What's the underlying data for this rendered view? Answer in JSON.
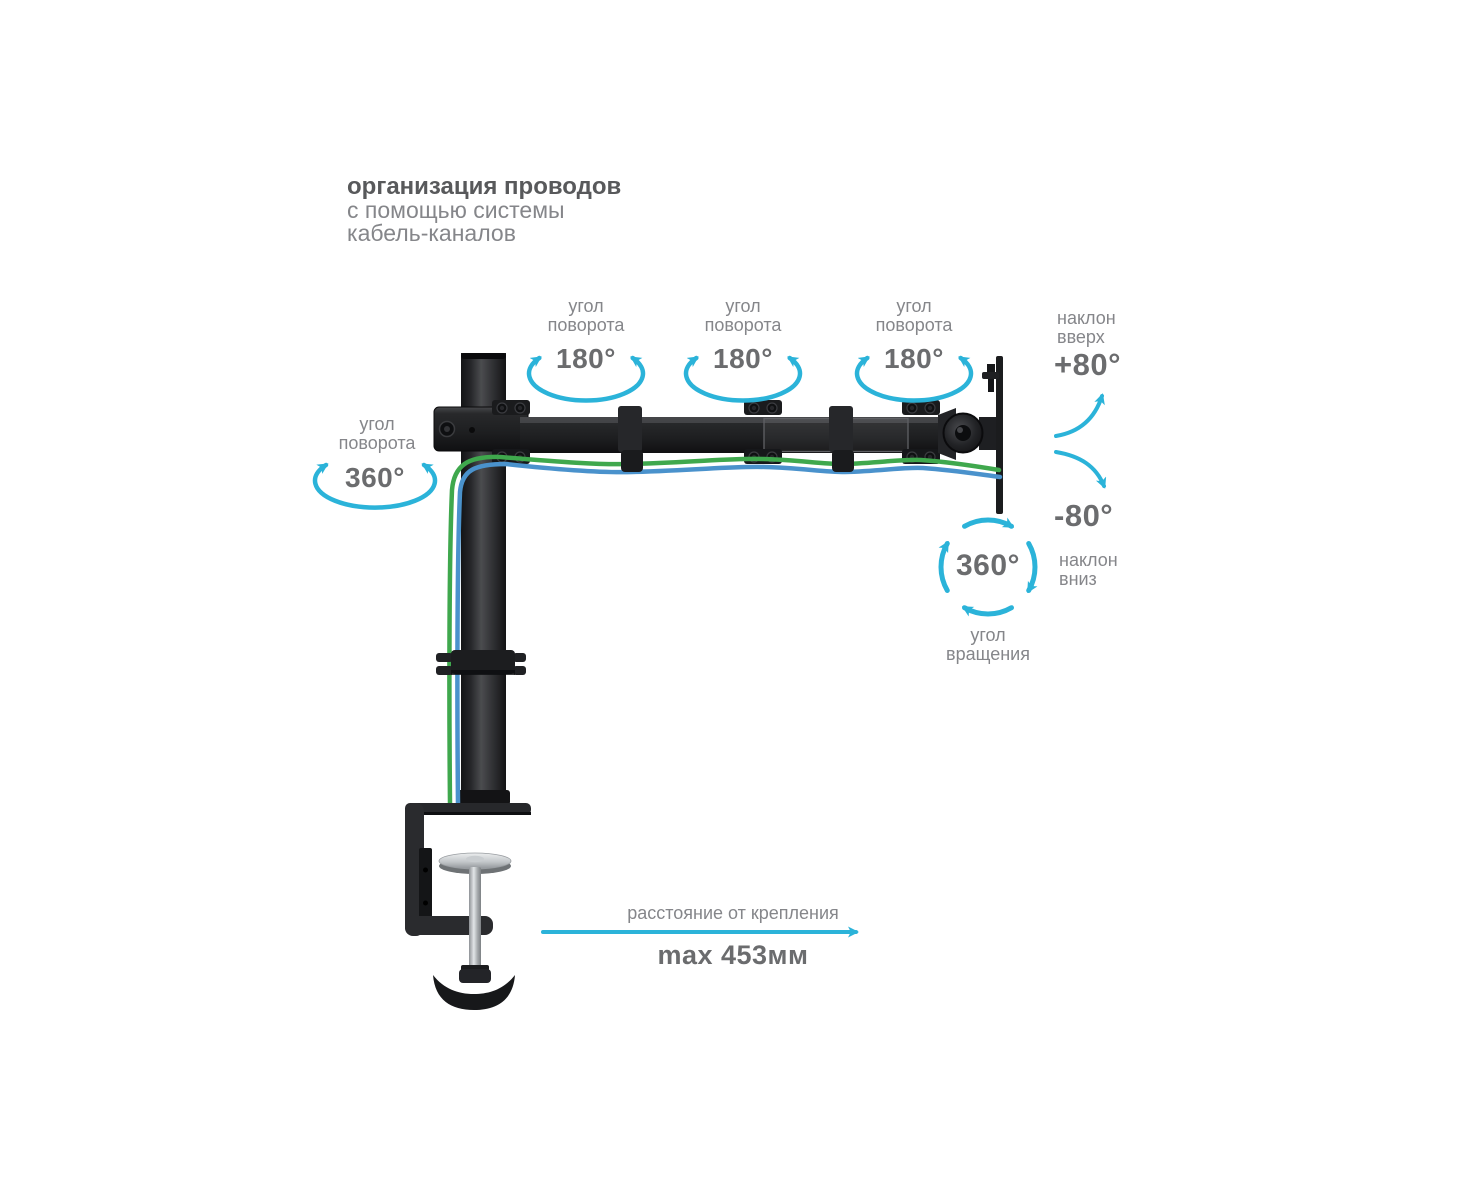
{
  "title": {
    "line1": "организация проводов",
    "line2": "с помощью системы",
    "line3": "кабель-каналов"
  },
  "annotations": {
    "arm_rotations": [
      {
        "label_line1": "угол",
        "label_line2": "поворота",
        "value": "180°"
      },
      {
        "label_line1": "угол",
        "label_line2": "поворота",
        "value": "180°"
      },
      {
        "label_line1": "угол",
        "label_line2": "поворота",
        "value": "180°"
      }
    ],
    "pole_rotation": {
      "label_line1": "угол",
      "label_line2": "поворота",
      "value": "360°"
    },
    "tilt_up": {
      "label_line1": "наклон",
      "label_line2": "вверх",
      "value": "+80°"
    },
    "tilt_down": {
      "label_line1": "наклон",
      "label_line2": "вниз",
      "value": "-80°"
    },
    "screen_rotation": {
      "label_line1": "угол",
      "label_line2": "вращения",
      "value": "360°"
    },
    "distance": {
      "label": "расстояние от крепления",
      "value": "max 453мм"
    }
  },
  "colors": {
    "accent": "#2bb3d9",
    "label_text": "#85868a",
    "value_text": "#6b6c6e",
    "title_text": "#58595b",
    "subtitle_text": "#85868a",
    "cable_green": "#3fa84d",
    "cable_blue": "#4a92cc",
    "product_black": "#1d1e20",
    "metal_silver": "#c3c7ca"
  }
}
